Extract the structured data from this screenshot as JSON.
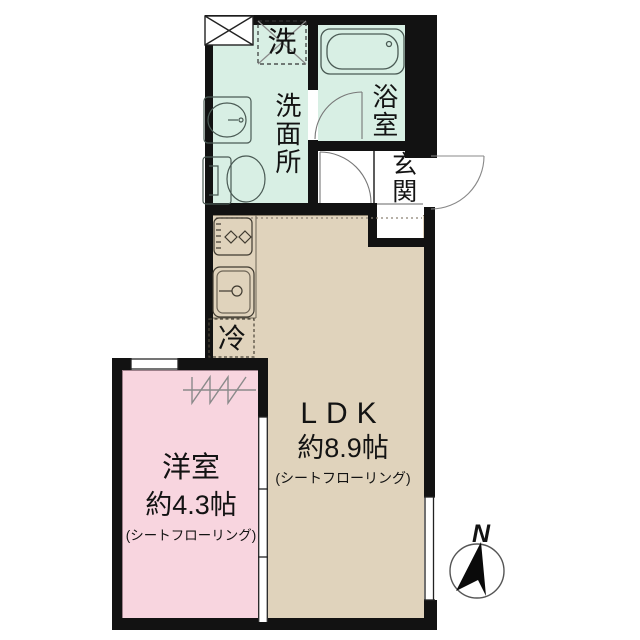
{
  "plan": {
    "rooms": {
      "ldk": {
        "name": "LDK",
        "size": "約8.9帖",
        "flooring": "(シートフローリング)"
      },
      "western_room": {
        "name": "洋室",
        "size": "約4.3帖",
        "flooring": "(シートフローリング)"
      },
      "washroom": {
        "name": "洗面所"
      },
      "bathroom": {
        "name": "浴室"
      },
      "entrance": {
        "name": "玄関"
      }
    },
    "fixtures": {
      "washing_machine": "洗",
      "refrigerator": "冷"
    },
    "compass": {
      "north": "N"
    },
    "colors": {
      "wet_area": "#d8efe4",
      "ldk": "#e0d3bc",
      "western_room": "#f8d5df",
      "wall": "#121212"
    }
  }
}
